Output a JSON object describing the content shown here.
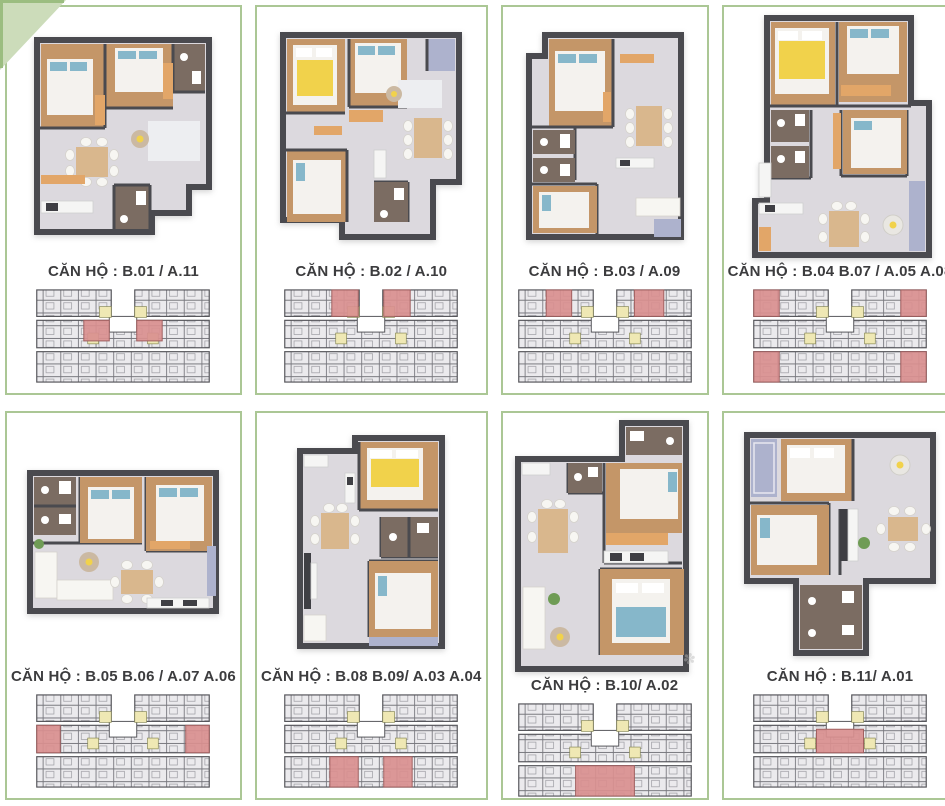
{
  "page": {
    "width": 945,
    "height": 806,
    "background": "#ffffff"
  },
  "theme": {
    "card_border": "#abc795",
    "corner_triangle_fill": "#ccdcba",
    "corner_triangle_edge": "#9bbd80",
    "label_color": "#3c3c3e",
    "keyplan_unit_fill": "#ebeaed",
    "keyplan_grid_line": "#77777d",
    "keyplan_wall_line": "#55555a",
    "keyplan_inner_line": "#9a9aa0",
    "highlight_red": "#d98f8f",
    "highlight_red_stroke": "#a05f5f",
    "highlight_yellow": "#efe8b4",
    "highlight_yellow_stroke": "#8a8a55"
  },
  "cards": [
    {
      "label": "CĂN HỘ : B.01 / A.11",
      "keyplan_highlights": [
        [
          60,
          34,
          26,
          21
        ],
        [
          114,
          34,
          26,
          21
        ]
      ]
    },
    {
      "label": "CĂN HỘ : B.02 / A.10",
      "keyplan_highlights": [
        [
          60,
          3,
          27,
          27
        ],
        [
          113,
          3,
          27,
          27
        ]
      ]
    },
    {
      "label": "CĂN HỘ : B.03 / A.09",
      "keyplan_highlights": [
        [
          40,
          3,
          26,
          27
        ],
        [
          130,
          3,
          30,
          27
        ]
      ]
    },
    {
      "label": "CĂN HỘ : B.04 B.07 / A.05 A.08",
      "keyplan_highlights": [
        [
          12,
          3,
          26,
          27
        ],
        [
          162,
          3,
          26,
          27
        ],
        [
          12,
          66,
          26,
          31
        ],
        [
          162,
          66,
          26,
          31
        ]
      ]
    },
    {
      "label": "CĂN HỘ : B.05 B.06 / A.07 A.06",
      "keyplan_highlights": [
        [
          12,
          34,
          24,
          28
        ],
        [
          164,
          34,
          24,
          28
        ]
      ]
    },
    {
      "label": "CĂN HỘ : B.08 B.09/ A.03 A.04",
      "keyplan_highlights": [
        [
          58,
          66,
          29,
          31
        ],
        [
          113,
          66,
          29,
          31
        ]
      ]
    },
    {
      "label": "CĂN HỘ : B.10/ A.02",
      "keyplan_highlights": [
        [
          70,
          66,
          60,
          31
        ]
      ]
    },
    {
      "label": "CĂN HỘ : B.11/ A.01",
      "keyplan_highlights": [
        [
          76,
          38,
          48,
          24
        ]
      ]
    }
  ],
  "watermark_glyph": "✽"
}
